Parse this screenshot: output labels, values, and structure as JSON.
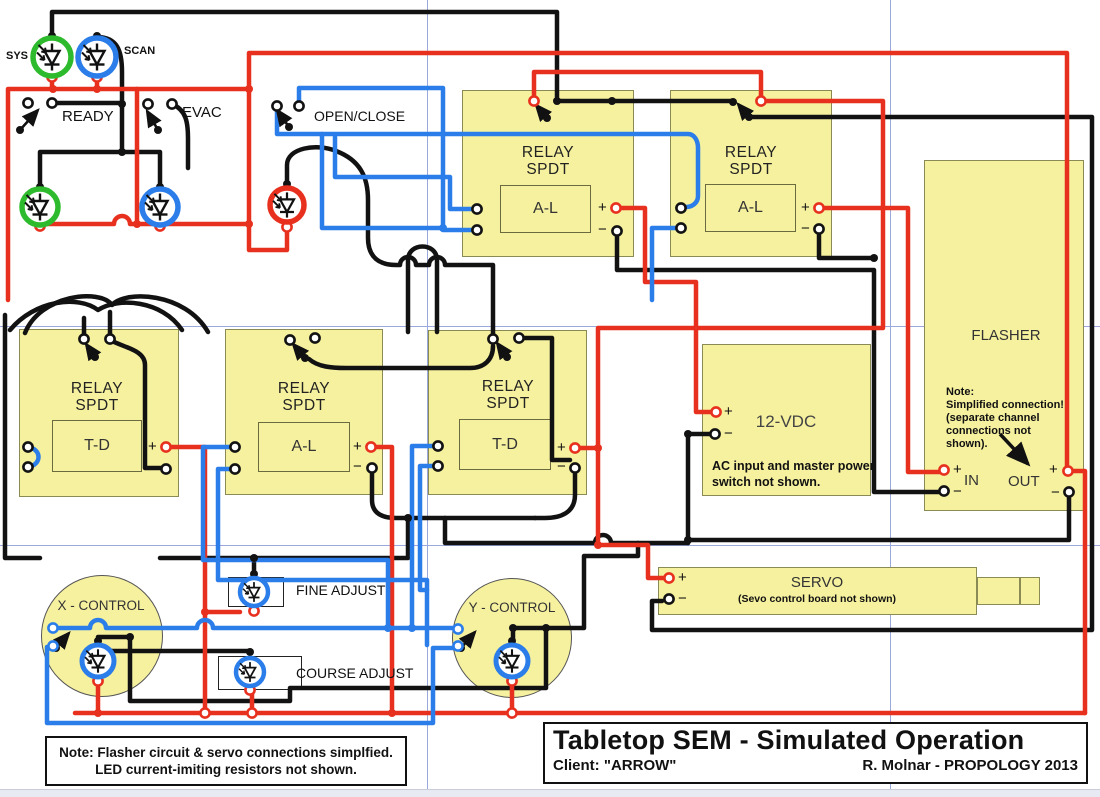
{
  "colors": {
    "wire_red": "#e8301f",
    "wire_blue": "#2b7de9",
    "wire_black": "#121212",
    "block_fill": "#f6f19f",
    "led_green": "#2dbb2d"
  },
  "indicators": {
    "sys": "SYS",
    "scan": "SCAN"
  },
  "switches": {
    "ready": "READY",
    "evac": "EVAC",
    "open_close": "OPEN/CLOSE"
  },
  "controls": {
    "x": "X - CONTROL",
    "y": "Y - CONTROL",
    "fine": "FINE ADJUST",
    "course": "COURSE ADJUST"
  },
  "relays": {
    "title": "RELAY",
    "subtitle": "SPDT",
    "top1_coil": "A-L",
    "top2_coil": "A-L",
    "mid1_coil": "T-D",
    "mid2_coil": "A-L",
    "mid3_coil": "T-D"
  },
  "terminals": {
    "plus": "+",
    "minus": "−"
  },
  "power": {
    "label": "12-VDC",
    "note1": "AC input and master power",
    "note2": "switch not shown."
  },
  "flasher": {
    "label": "FLASHER",
    "in": "IN",
    "out": "OUT",
    "note1": "Note:",
    "note2": "Simplified connection!",
    "note3": "(separate channel",
    "note4": "connections not",
    "note5": "shown)."
  },
  "servo": {
    "label": "SERVO",
    "subtitle": "(Sevo control board not shown)"
  },
  "notes": {
    "bottom1": "Note: Flasher circuit & servo connections simplfied.",
    "bottom2": "LED current-imiting resistors not shown."
  },
  "title_block": {
    "title": "Tabletop SEM - Simulated Operation",
    "client": "Client: \"ARROW\"",
    "credit": "R. Molnar - PROPOLOGY 2013"
  }
}
